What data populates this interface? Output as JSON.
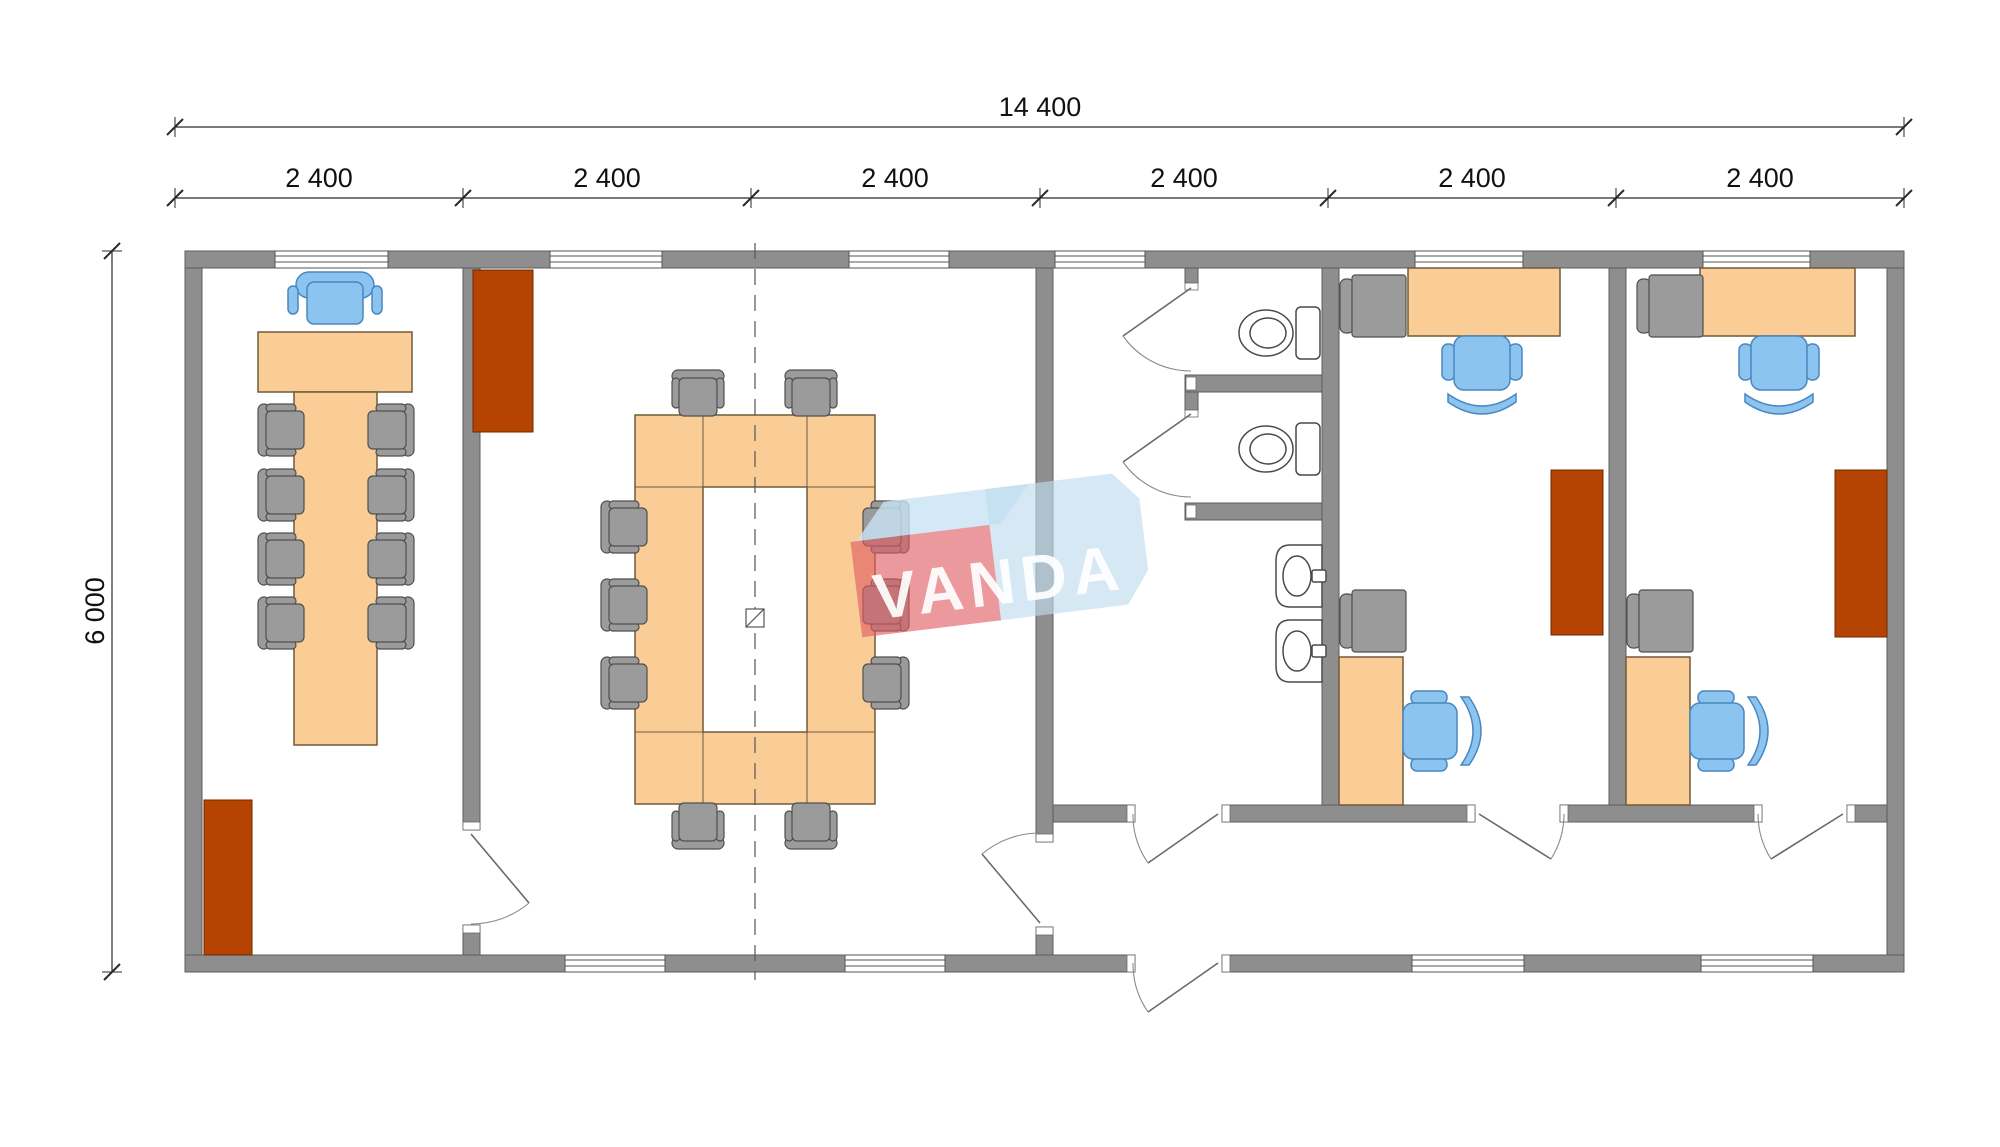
{
  "dimensions": {
    "total_width": {
      "label": "14 400"
    },
    "modules": [
      {
        "label": "2 400"
      },
      {
        "label": "2 400"
      },
      {
        "label": "2 400"
      },
      {
        "label": "2 400"
      },
      {
        "label": "2 400"
      },
      {
        "label": "2 400"
      }
    ],
    "total_height": {
      "label": "6 000"
    }
  },
  "logo": {
    "text": "VANDA"
  },
  "colors": {
    "wall": "#8E8E8E",
    "table": "#FACD96",
    "chair_gray": "#9B9B9B",
    "chair_blue": "#8CC4F0",
    "radiator": "#B54301",
    "logo_red": "#E05A63",
    "logo_blue": "#BFDCEF",
    "logo_ribbon": "#C9E3F5"
  },
  "legend": {
    "rooms": [
      "meeting-room",
      "conference-room",
      "sanitary-block",
      "office-1",
      "office-2",
      "corridor"
    ],
    "fixtures": [
      "meeting-table",
      "conference-ring-table",
      "executive-chair",
      "side-chair",
      "task-chair",
      "desk",
      "cabinet",
      "radiator",
      "toilet",
      "sink",
      "window",
      "door",
      "column-symbol",
      "centerline"
    ]
  }
}
